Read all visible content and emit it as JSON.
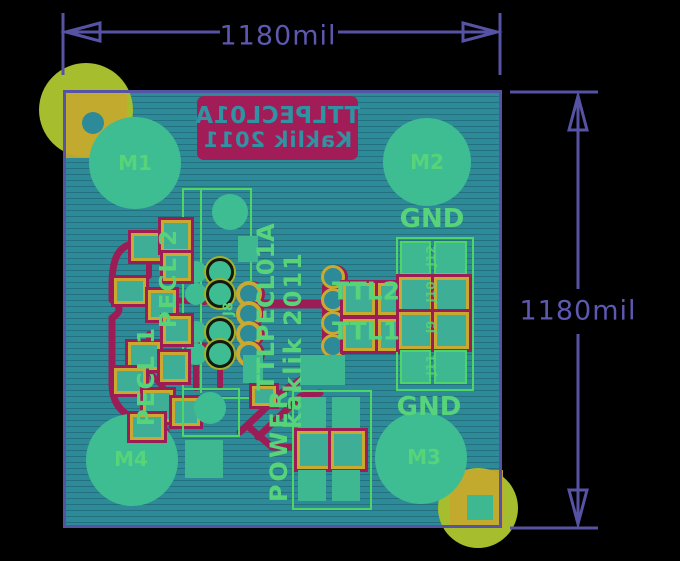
{
  "view": {
    "width": 680,
    "height": 561
  },
  "palette": {
    "background": "#000000",
    "dimension_purple": "#5652a4",
    "board_teal": "#2d8b99",
    "front_silk_green": "#57d37a",
    "copper_yellow": "#c9a92f",
    "back_silk_red": "#9e1d56",
    "pad_green": "#3ebd92",
    "drill_olive": "#a6bd2e"
  },
  "dimensions": {
    "top_label": "1180mil",
    "right_label": "1180mil"
  },
  "back_silkscreen": {
    "line1": "TTLPECL01A",
    "line2": "Kaklik 2011"
  },
  "mounting_holes": [
    {
      "label": "M1"
    },
    {
      "label": "M2"
    },
    {
      "label": "M3"
    },
    {
      "label": "M4"
    }
  ],
  "silk_labels": {
    "gnd_top": "GND",
    "gnd_bottom": "GND",
    "pecl2": "PECL 2",
    "pecl1": "PECL 1",
    "ttl2": "TTL2",
    "ttl1": "TTL1",
    "power": "POWER",
    "board_title": "TTLPECL01A",
    "board_author": "kaklik 2011",
    "j8": "J8"
  },
  "right_header_connectors": [
    {
      "ref": "J12"
    },
    {
      "ref": "J10"
    },
    {
      "ref": "J9"
    },
    {
      "ref": "J11"
    }
  ]
}
